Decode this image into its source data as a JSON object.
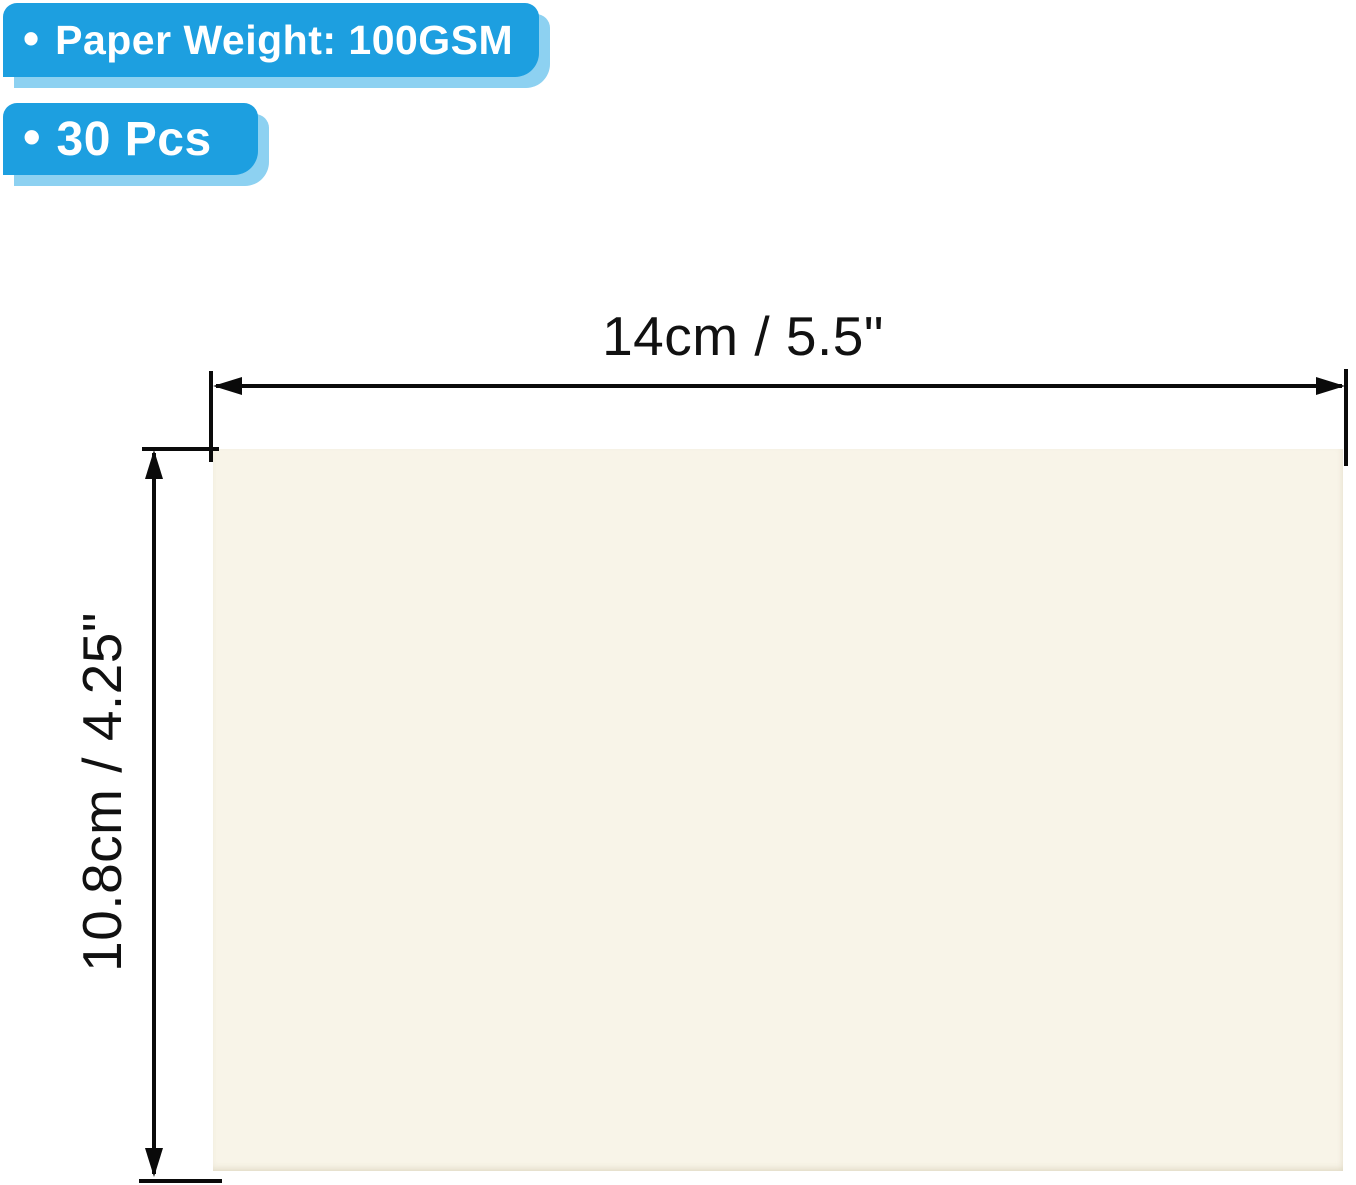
{
  "product": {
    "badges": [
      {
        "bullet": "•",
        "label": "Paper Weight: 100GSM"
      },
      {
        "bullet": "•",
        "label": "30 Pcs"
      }
    ],
    "paper_item": "blank cream paper card"
  },
  "dimensions": {
    "width_label": "14cm / 5.5\"",
    "height_label": "10.8cm / 4.25\""
  },
  "colors": {
    "badge_blue": "#1D9FE0",
    "badge_shadow": "#8DD1F1",
    "paper_cream": "#F8F4E8",
    "line_color": "#0A0A0A",
    "text_dark": "#111111"
  }
}
